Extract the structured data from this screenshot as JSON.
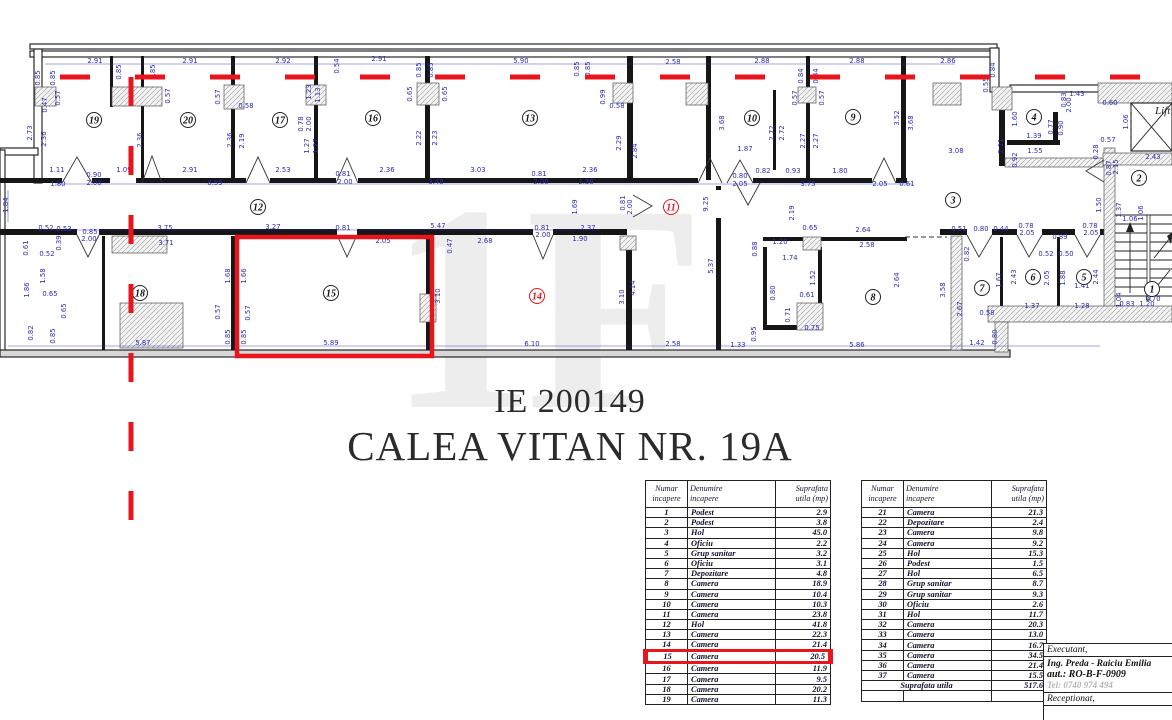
{
  "colors": {
    "red": "#e8151c",
    "blue_dim": "#2b2bb5",
    "wall": "#161616",
    "gray_tel": "#b5b5b5",
    "watermark": "#ededed"
  },
  "title": {
    "line1": "IE 200149",
    "line2": "CALEA VITAN NR. 19A"
  },
  "watermark_text": "1F",
  "plan": {
    "lift_label": "Lift",
    "rooms": [
      [
        "19",
        94,
        120,
        0
      ],
      [
        "20",
        188,
        120,
        0
      ],
      [
        "17",
        280,
        120,
        0
      ],
      [
        "16",
        373,
        118,
        0
      ],
      [
        "13",
        530,
        118,
        0
      ],
      [
        "10",
        752,
        118,
        0
      ],
      [
        "9",
        853,
        117,
        0
      ],
      [
        "4",
        1034,
        117,
        0
      ],
      [
        "12",
        258,
        207,
        0
      ],
      [
        "11",
        671,
        207,
        1
      ],
      [
        "3",
        953,
        200,
        0
      ],
      [
        "2",
        1139,
        178,
        0
      ],
      [
        "18",
        140,
        293,
        0
      ],
      [
        "15",
        331,
        293,
        0
      ],
      [
        "14",
        537,
        296,
        1
      ],
      [
        "8",
        873,
        297,
        0
      ],
      [
        "7",
        982,
        288,
        0
      ],
      [
        "6",
        1033,
        277,
        0
      ],
      [
        "5",
        1084,
        277,
        0
      ],
      [
        "1",
        1152,
        289,
        0
      ]
    ],
    "dimensions": [
      [
        "2.91",
        95,
        63,
        0
      ],
      [
        "2.91",
        190,
        63,
        0
      ],
      [
        "2.92",
        283,
        63,
        0
      ],
      [
        "2.91",
        379,
        61,
        0
      ],
      [
        "5.90",
        521,
        63,
        0
      ],
      [
        "2.58",
        673,
        64,
        0
      ],
      [
        "2.88",
        762,
        63,
        0
      ],
      [
        "2.88",
        857,
        63,
        0
      ],
      [
        "2.86",
        948,
        63,
        0
      ],
      [
        "1.43",
        1077,
        96,
        0
      ],
      [
        "0.60",
        1110,
        105,
        0
      ],
      [
        "0.84",
        995,
        70,
        1
      ],
      [
        "0.55",
        988,
        85,
        1
      ],
      [
        "0.85",
        40,
        78,
        1
      ],
      [
        "0.85",
        55,
        78,
        1
      ],
      [
        "0.57",
        60,
        98,
        1
      ],
      [
        "0.47",
        47,
        105,
        1
      ],
      [
        "2.73",
        32,
        133,
        1
      ],
      [
        "2.36",
        46,
        139,
        1
      ],
      [
        "0.85",
        121,
        72,
        1
      ],
      [
        "0.85",
        155,
        72,
        1
      ],
      [
        "0.57",
        170,
        96,
        1
      ],
      [
        "2.36",
        142,
        140,
        1
      ],
      [
        "1.23",
        311,
        92,
        1
      ],
      [
        "1.13",
        320,
        95,
        1
      ],
      [
        "0.78",
        303,
        124,
        1
      ],
      [
        "2.00",
        311,
        124,
        1
      ],
      [
        "1.27",
        309,
        146,
        1
      ],
      [
        "1.27",
        318,
        146,
        1
      ],
      [
        "0.54",
        339,
        66,
        1
      ],
      [
        "0.85",
        421,
        70,
        1
      ],
      [
        "0.85",
        433,
        70,
        1
      ],
      [
        "0.65",
        412,
        94,
        1
      ],
      [
        "0.65",
        447,
        94,
        1
      ],
      [
        "2.22",
        421,
        138,
        1
      ],
      [
        "2.23",
        437,
        138,
        1
      ],
      [
        "0.85",
        579,
        69,
        1
      ],
      [
        "0.85",
        590,
        69,
        1
      ],
      [
        "0.57",
        220,
        97,
        1
      ],
      [
        "0.58",
        246,
        108,
        0
      ],
      [
        "2.36",
        232,
        140,
        1
      ],
      [
        "2.19",
        244,
        141,
        1
      ],
      [
        "0.99",
        605,
        97,
        1
      ],
      [
        "0.58",
        617,
        108,
        0
      ],
      [
        "2.29",
        621,
        143,
        1
      ],
      [
        "2.84",
        637,
        151,
        1
      ],
      [
        "0.84",
        803,
        76,
        1
      ],
      [
        "0.84",
        818,
        76,
        1
      ],
      [
        "0.57",
        797,
        98,
        1
      ],
      [
        "0.57",
        824,
        98,
        1
      ],
      [
        "3.68",
        724,
        123,
        1
      ],
      [
        "2.72",
        774,
        133,
        1
      ],
      [
        "2.72",
        784,
        133,
        1
      ],
      [
        "2.27",
        805,
        141,
        1
      ],
      [
        "2.27",
        818,
        141,
        1
      ],
      [
        "3.52",
        899,
        118,
        1
      ],
      [
        "3.68",
        913,
        123,
        1
      ],
      [
        "1.87",
        745,
        151,
        0
      ],
      [
        "1.60",
        1017,
        119,
        1
      ],
      [
        "0.77",
        1053,
        127,
        1
      ],
      [
        "0.90",
        1063,
        128,
        1
      ],
      [
        "1.39",
        1034,
        138,
        0
      ],
      [
        "1.55",
        1035,
        153,
        0
      ],
      [
        "0.92",
        1017,
        160,
        1
      ],
      [
        "2.11",
        1003,
        146,
        1
      ],
      [
        "3.08",
        956,
        153,
        0
      ],
      [
        "1.06",
        1128,
        122,
        1
      ],
      [
        "0.57",
        1108,
        142,
        0
      ],
      [
        "0.28",
        1098,
        152,
        1
      ],
      [
        "2.43",
        1153,
        159,
        0
      ],
      [
        "0.83",
        1066,
        100,
        1
      ],
      [
        "2.00",
        1071,
        105,
        1
      ],
      [
        "1.11",
        57,
        172,
        0
      ],
      [
        "0.90",
        94,
        177,
        0
      ],
      [
        "2.00",
        94,
        185,
        0
      ],
      [
        "1.80",
        58,
        186,
        0
      ],
      [
        "1.09",
        124,
        172,
        0
      ],
      [
        "2.91",
        190,
        172,
        0
      ],
      [
        "8.95",
        215,
        185,
        0
      ],
      [
        "2.53",
        283,
        172,
        0
      ],
      [
        "2.36",
        387,
        172,
        0
      ],
      [
        "3.03",
        478,
        172,
        0
      ],
      [
        "0.81",
        539,
        176,
        0
      ],
      [
        "2.00",
        541,
        184,
        0
      ],
      [
        "2.36",
        590,
        172,
        0
      ],
      [
        "3.48",
        436,
        184,
        0
      ],
      [
        "2.38",
        586,
        184,
        0
      ],
      [
        "0.81",
        343,
        176,
        0
      ],
      [
        "2.00",
        345,
        184,
        0
      ],
      [
        "0.82",
        763,
        173,
        0
      ],
      [
        "0.93",
        793,
        173,
        0
      ],
      [
        "1.80",
        840,
        173,
        0
      ],
      [
        "0.80",
        740,
        178,
        0
      ],
      [
        "2.05",
        740,
        186,
        0
      ],
      [
        "3.75",
        808,
        186,
        0
      ],
      [
        "2.05",
        880,
        186,
        0
      ],
      [
        "0.61",
        907,
        186,
        0
      ],
      [
        "1.84",
        8,
        205,
        1
      ],
      [
        "1.69",
        577,
        207,
        1
      ],
      [
        "0.81",
        625,
        203,
        1
      ],
      [
        "2.00",
        632,
        207,
        1
      ],
      [
        "9.25",
        708,
        204,
        1
      ],
      [
        "2.19",
        794,
        213,
        1
      ],
      [
        "5.37",
        713,
        266,
        1
      ],
      [
        "0.52",
        46,
        230,
        0
      ],
      [
        "0.53",
        64,
        231,
        0
      ],
      [
        "0.85",
        90,
        234,
        0
      ],
      [
        "2.00",
        89,
        241,
        0
      ],
      [
        "3.75",
        165,
        230,
        0
      ],
      [
        "3.71",
        166,
        245,
        0
      ],
      [
        "3.27",
        273,
        229,
        0
      ],
      [
        "0.81",
        343,
        230,
        0
      ],
      [
        "5.47",
        438,
        228,
        0
      ],
      [
        "0.81",
        542,
        230,
        0
      ],
      [
        "2.00",
        543,
        237,
        0
      ],
      [
        "2.37",
        588,
        230,
        0
      ],
      [
        "1.90",
        580,
        241,
        0
      ],
      [
        "2.68",
        485,
        243,
        0
      ],
      [
        "0.47",
        452,
        246,
        1
      ],
      [
        "2.05",
        383,
        243,
        0
      ],
      [
        "0.78",
        1026,
        228,
        0
      ],
      [
        "2.05",
        1027,
        235,
        0
      ],
      [
        "0.89",
        1060,
        239,
        0
      ],
      [
        "0.78",
        1090,
        228,
        0
      ],
      [
        "2.05",
        1091,
        235,
        0
      ],
      [
        "0.51",
        959,
        231,
        0
      ],
      [
        "0.80",
        981,
        231,
        0
      ],
      [
        "0.44",
        1001,
        231,
        0
      ],
      [
        "1.50",
        1101,
        205,
        1
      ],
      [
        "1.37",
        1121,
        210,
        1
      ],
      [
        "1.06",
        1143,
        213,
        1
      ],
      [
        "1.06",
        1130,
        221,
        0
      ],
      [
        "0.87",
        1111,
        168,
        1
      ],
      [
        "2.15",
        1118,
        167,
        1
      ],
      [
        "1.68",
        230,
        276,
        1
      ],
      [
        "1.66",
        246,
        276,
        1
      ],
      [
        "0.57",
        220,
        312,
        1
      ],
      [
        "0.57",
        250,
        313,
        1
      ],
      [
        "0.85",
        230,
        337,
        1
      ],
      [
        "0.85",
        246,
        337,
        1
      ],
      [
        "3.10",
        440,
        296,
        1
      ],
      [
        "3.10",
        624,
        297,
        1
      ],
      [
        "4.14",
        635,
        288,
        1
      ],
      [
        "1.58",
        45,
        276,
        1
      ],
      [
        "1.86",
        29,
        290,
        1
      ],
      [
        "0.65",
        50,
        296,
        0
      ],
      [
        "0.65",
        66,
        311,
        1
      ],
      [
        "0.82",
        33,
        333,
        1
      ],
      [
        "0.85",
        55,
        336,
        1
      ],
      [
        "0.52",
        47,
        256,
        0
      ],
      [
        "0.39",
        61,
        243,
        1
      ],
      [
        "0.61",
        28,
        248,
        1
      ],
      [
        "5.87",
        143,
        345,
        0
      ],
      [
        "5.89",
        331,
        345,
        0
      ],
      [
        "6.10",
        532,
        346,
        0
      ],
      [
        "2.58",
        673,
        346,
        0
      ],
      [
        "1.33",
        738,
        347,
        0
      ],
      [
        "5.86",
        857,
        347,
        0
      ],
      [
        "1.42",
        977,
        345,
        0
      ],
      [
        "0.80",
        997,
        337,
        1
      ],
      [
        "0.95",
        756,
        334,
        1
      ],
      [
        "0.65",
        810,
        230,
        0
      ],
      [
        "1.20",
        780,
        244,
        0
      ],
      [
        "1.74",
        790,
        260,
        0
      ],
      [
        "0.88",
        757,
        249,
        1
      ],
      [
        "1.52",
        815,
        278,
        1
      ],
      [
        "2.64",
        899,
        280,
        1
      ],
      [
        "2.64",
        863,
        232,
        0
      ],
      [
        "2.58",
        867,
        247,
        0
      ],
      [
        "0.61",
        807,
        297,
        0
      ],
      [
        "0.71",
        790,
        315,
        1
      ],
      [
        "0.75",
        812,
        330,
        0
      ],
      [
        "0.80",
        775,
        293,
        1
      ],
      [
        "3.58",
        945,
        290,
        1
      ],
      [
        "2.67",
        962,
        309,
        1
      ],
      [
        "2.43",
        1016,
        277,
        1
      ],
      [
        "2.05",
        1049,
        278,
        1
      ],
      [
        "1.88",
        1065,
        278,
        1
      ],
      [
        "2.44",
        1098,
        277,
        1
      ],
      [
        "1.67",
        1001,
        280,
        1
      ],
      [
        "0.58",
        987,
        315,
        0
      ],
      [
        "1.41",
        1082,
        288,
        0
      ],
      [
        "1.37",
        1032,
        308,
        0
      ],
      [
        "1.28",
        1082,
        308,
        0
      ],
      [
        "1.04",
        1121,
        300,
        1
      ],
      [
        "0.83",
        1127,
        306,
        0
      ],
      [
        "1.20",
        1147,
        306,
        0
      ],
      [
        "0.70",
        1153,
        301,
        0
      ],
      [
        "0.82",
        969,
        254,
        1
      ],
      [
        "0.52",
        1046,
        256,
        0
      ],
      [
        "0.50",
        1066,
        256,
        0
      ]
    ]
  },
  "tables": {
    "headers": [
      "Numar\nincapere",
      "Denumire\nincapere",
      "Suprafata\nutila (mp)"
    ],
    "left_rows": [
      [
        "1",
        "Podest",
        "2.9"
      ],
      [
        "2",
        "Podest",
        "3.8"
      ],
      [
        "3",
        "Hol",
        "45.0"
      ],
      [
        "4",
        "Oficiu",
        "2.2"
      ],
      [
        "5",
        "Grup sanitar",
        "3.2"
      ],
      [
        "6",
        "Oficiu",
        "3.1"
      ],
      [
        "7",
        "Depozitare",
        "4.8"
      ],
      [
        "8",
        "Camera",
        "18.9"
      ],
      [
        "9",
        "Camera",
        "10.4"
      ],
      [
        "10",
        "Camera",
        "10.3"
      ],
      [
        "11",
        "Camera",
        "23.8"
      ],
      [
        "12",
        "Hol",
        "41.8"
      ],
      [
        "13",
        "Camera",
        "22.3"
      ],
      [
        "14",
        "Camera",
        "21.4"
      ],
      [
        "15",
        "Camera",
        "20.5"
      ],
      [
        "16",
        "Camera",
        "11.9"
      ],
      [
        "17",
        "Camera",
        "9.5"
      ],
      [
        "18",
        "Camera",
        "20.2"
      ],
      [
        "19",
        "Camera",
        "11.3"
      ]
    ],
    "right_rows": [
      [
        "21",
        "Camera",
        "21.3"
      ],
      [
        "22",
        "Depozitare",
        "2.4"
      ],
      [
        "23",
        "Camera",
        "9.8"
      ],
      [
        "24",
        "Camera",
        "9.2"
      ],
      [
        "25",
        "Hol",
        "15.3"
      ],
      [
        "26",
        "Podest",
        "1.5"
      ],
      [
        "27",
        "Hol",
        "6.5"
      ],
      [
        "28",
        "Grup sanitar",
        "8.7"
      ],
      [
        "29",
        "Grup sanitar",
        "9.3"
      ],
      [
        "30",
        "Oficiu",
        "2.6"
      ],
      [
        "31",
        "Hol",
        "11.7"
      ],
      [
        "32",
        "Camera",
        "20.3"
      ],
      [
        "33",
        "Camera",
        "13.0"
      ],
      [
        "34",
        "Camera",
        "16.7"
      ],
      [
        "35",
        "Camera",
        "34.5"
      ],
      [
        "36",
        "Camera",
        "21.4"
      ],
      [
        "37",
        "Camera",
        "15.5"
      ]
    ],
    "total_label": "Suprafata utila",
    "total_value": "517.6",
    "highlight_row": "15"
  },
  "stamp": {
    "executant_label": "Executant,",
    "name": "Ing. Preda - Raiciu Emilia",
    "aut": "aut.: RO-B-F-0909",
    "tel": "Tel: 0740 974 494",
    "receptionat_label": "Receptionat,"
  }
}
